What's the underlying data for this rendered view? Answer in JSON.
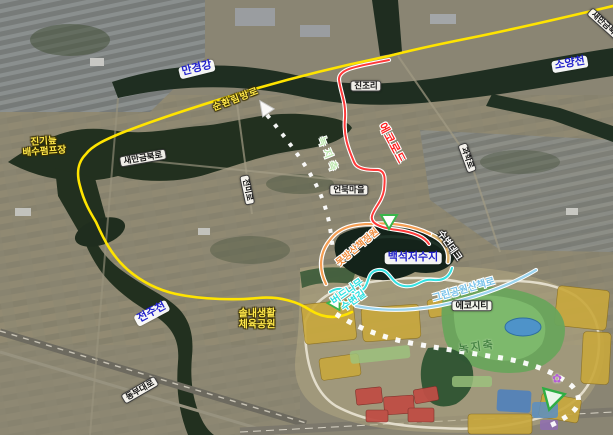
{
  "map": {
    "waterways": {
      "mangyeong": "만경강",
      "soyang": "소양천",
      "jeonju": "전주천",
      "reservoir": "백석저수지"
    },
    "roads": {
      "sunhwanimbang": "순환림방로",
      "saemangeum": "새만금북로",
      "saemangeum_corner": "새만금북로",
      "jeonmi": "전미로",
      "gwahak": "과학로",
      "dongbu": "동부대로"
    },
    "places": {
      "jinjori": "진조리",
      "eonbuk": "언북마을",
      "ecocity": "에코시티",
      "pump_line1": "진기늪",
      "pump_line2": "배수펌프장",
      "sports_line1": "솔내생활",
      "sports_line2": "체육공원"
    },
    "trails": {
      "eco_road": "에코로드",
      "deck": "수변데크",
      "motbang_garden": "못방산책정원",
      "willow_line1": "버드나무",
      "willow_line2": "수변길",
      "green_park": "그린공원산책로",
      "green_axis_upper": "녹지축",
      "green_axis_lower": "녹지축"
    },
    "icons": {
      "flower": "✿",
      "route_arrow": "direction-triangle",
      "trail_marker": "trail-triangle"
    },
    "colors": {
      "route_yellow": "#FFE400",
      "route_red": "#FF3A3A",
      "trail_orange": "#F59E53",
      "trail_cyan": "#35E2E2",
      "trail_lightblue": "#9BD4EE",
      "green_axis": "#FFFFFF",
      "river_label_blue": "#2222CC",
      "label_text_yellow": "#FFE84A"
    }
  }
}
